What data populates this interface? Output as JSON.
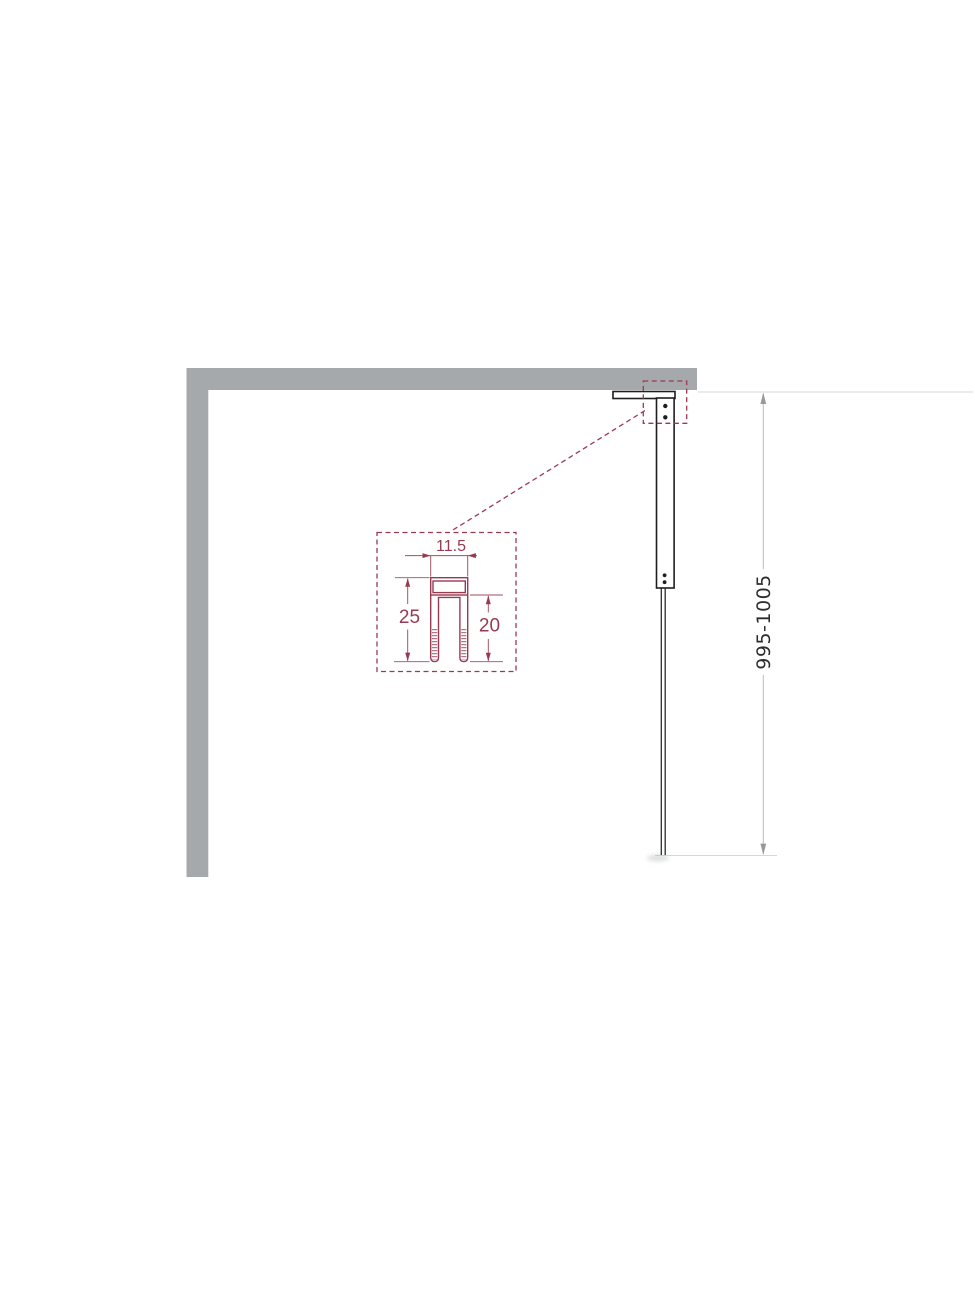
{
  "colors": {
    "wall": "#a6a9ab",
    "outline": "#1e1e1e",
    "accent_red": "#993a52",
    "dim_line": "#bfc1c2",
    "dim_arrow": "#97999b",
    "ext_line": "#d6d7d8",
    "dim_text": "#2e2e2e"
  },
  "dimensions": {
    "profile_width": "11.5",
    "profile_height": "25",
    "profile_inner_height": "20",
    "installation_height_range": "995-1005"
  }
}
